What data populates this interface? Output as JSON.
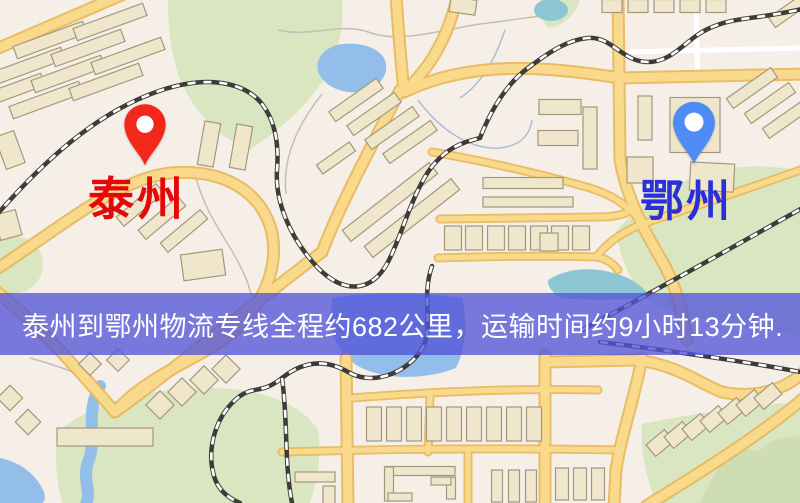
{
  "map": {
    "origin": {
      "label": "泰州",
      "label_color": "#e60808",
      "pin_icon": "red-map-pin-icon",
      "pin_color": "#f2281b"
    },
    "destination": {
      "label": "鄂州",
      "label_color": "#2a2fd8",
      "pin_icon": "blue-map-pin-icon",
      "pin_color": "#4f8bf5"
    },
    "banner": {
      "text": "泰州到鄂州物流专线全程约682公里，运输时间约9小时13分钟.",
      "bg_color": "rgba(83,85,216,0.78)",
      "text_color": "#ffffff"
    },
    "palette": {
      "background": "#f6efe8",
      "park": "#d9e6c1",
      "water": "#93bee9",
      "road_fill": "#f9da8c",
      "road_casing": "#e8b85e",
      "building_fill": "#efe6cb",
      "building_stroke": "#a2987c",
      "railway_dark": "#3d3c38"
    }
  }
}
